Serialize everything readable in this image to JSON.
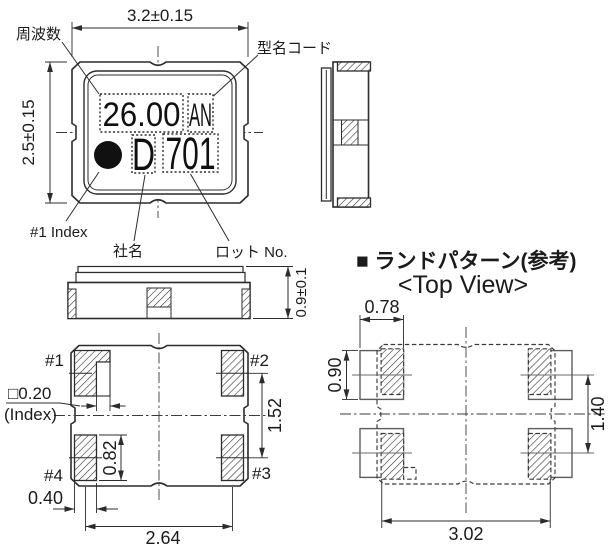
{
  "ink_color": "#2c2c2c",
  "package_top_view": {
    "dim_width": "3.2±0.15",
    "dim_height": "2.5±0.15",
    "callout_frequency": "周波数",
    "callout_model_code": "型名コード",
    "callout_index": "#1 Index",
    "callout_company": "社名",
    "callout_lot": "ロット No.",
    "marking_frequency": "26.00",
    "marking_model_code": "AN",
    "marking_company": "D",
    "marking_lot": "701"
  },
  "side_view": {
    "dim_thickness": "0.9±0.1"
  },
  "bottom_view": {
    "pad1_label": "#1",
    "pad2_label": "#2",
    "pad3_label": "#3",
    "pad4_label": "#4",
    "dim_index_notch": "□0.20",
    "index_note": "(Index)",
    "dim_pad_height": "0.82",
    "dim_pad_row_pitch": "1.52",
    "dim_pad_width": "0.40",
    "dim_pad_col_pitch": "2.64"
  },
  "land_pattern": {
    "heading": "■ ランドパターン(参考)",
    "subheading": "<Top View>",
    "dim_land_width": "0.78",
    "dim_land_height": "0.90",
    "dim_row_pitch": "1.40",
    "dim_col_pitch": "3.02"
  }
}
